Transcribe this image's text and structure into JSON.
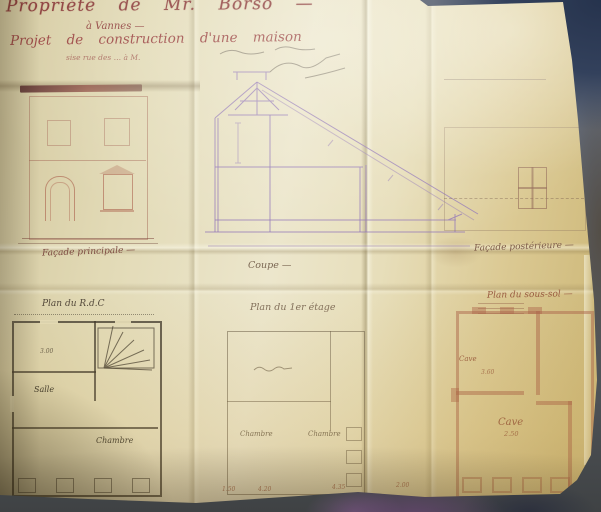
{
  "scene": {
    "kind": "photograph of a folded hand-drawn house construction plan on a grey table",
    "colors": {
      "table": "#5d636e",
      "table_dark_corner": "#26334d",
      "paper_light": "#ece6cc",
      "paper_mid": "#dbc993",
      "title_ink": "#8a3937",
      "section_ink": "#9478b6",
      "facade_ink": "#aa5f4b",
      "plan_dark_ink": "#3e372c",
      "basement_ink": "#ac664c"
    }
  },
  "title_block": {
    "line1": "Propriété de Mr. Borso —",
    "line2": "à Vannes —",
    "line3": "Projet de construction d'une maison",
    "line4": "sise rue des … à M."
  },
  "elevations": {
    "facade_principale": {
      "label": "Façade principale —"
    },
    "coupe": {
      "label": "Coupe —"
    },
    "facade_posterieure": {
      "label": "Façade postérieure —"
    }
  },
  "plans": {
    "rdc": {
      "label": "Plan du R.d.C",
      "rooms": [
        "Salle",
        "Chambre"
      ],
      "dims": [
        "3.00"
      ]
    },
    "etage": {
      "label": "Plan du 1er étage",
      "rooms": [
        "Chambre",
        "Chambre"
      ]
    },
    "sous_sol": {
      "label": "Plan du sous-sol —",
      "rooms": [
        "Cave",
        "Cave"
      ],
      "room_dims": [
        "3.60",
        "2.50"
      ]
    }
  },
  "dimensions": {
    "bottom_row": [
      "1.50",
      "4.20",
      "4.35",
      "2.00"
    ]
  }
}
